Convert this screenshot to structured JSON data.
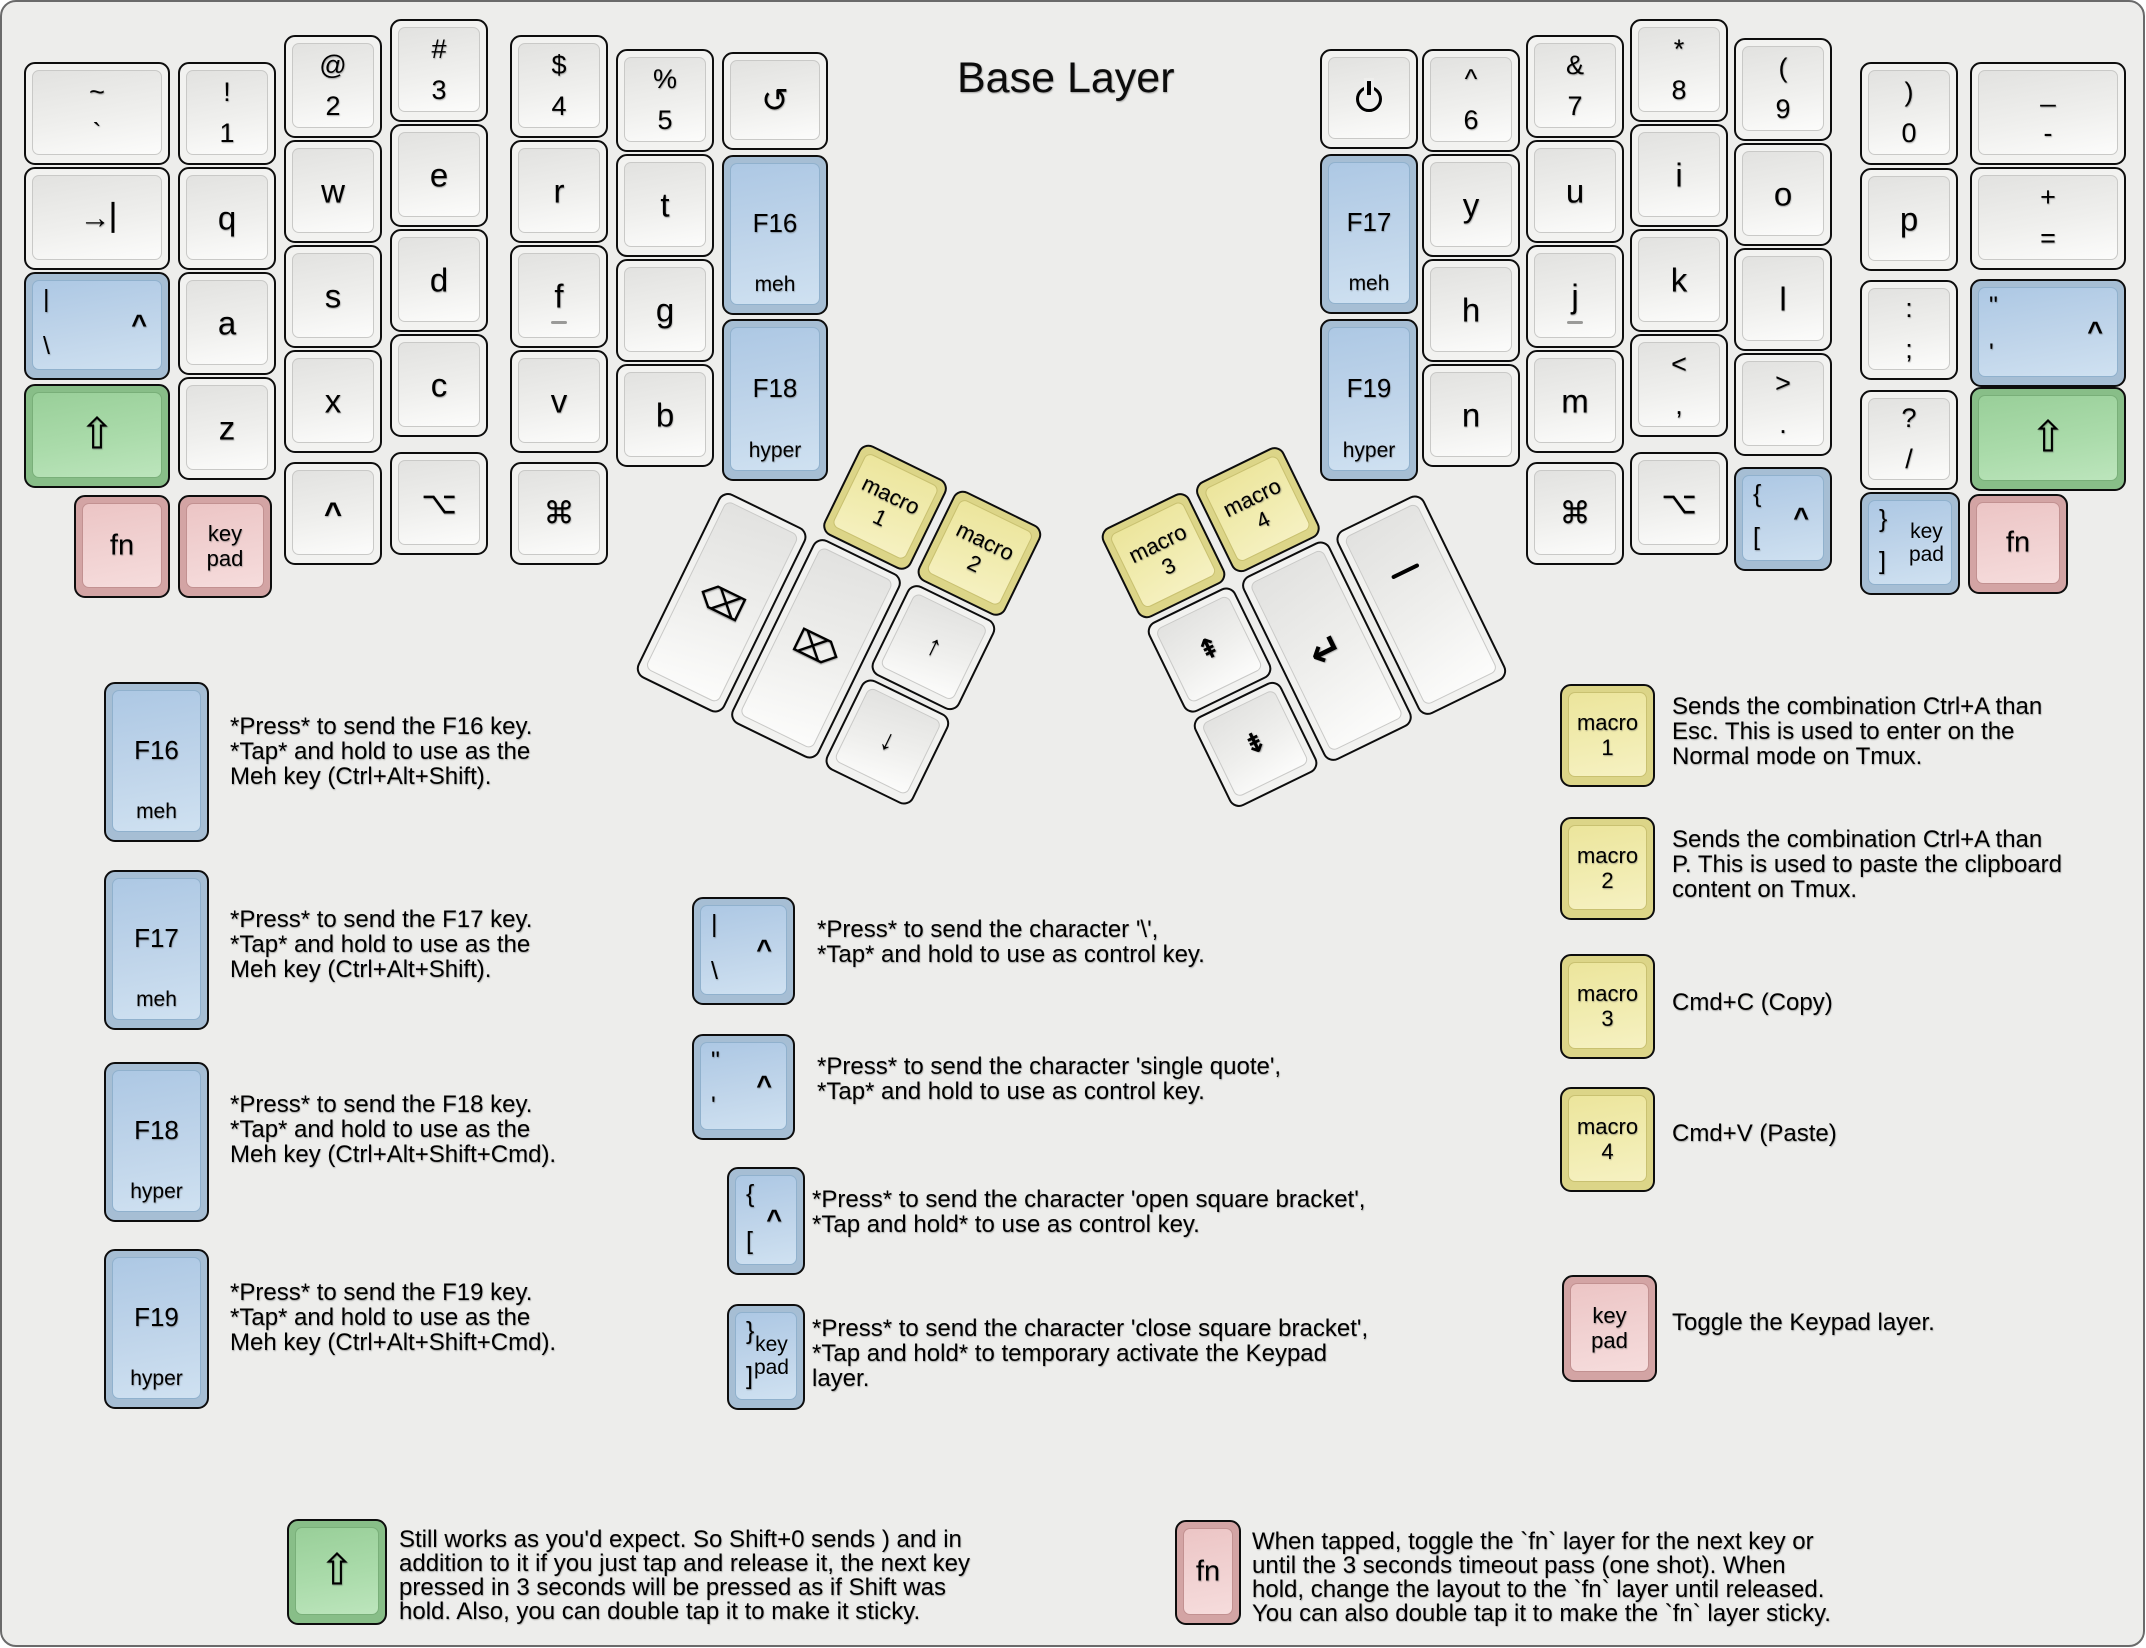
{
  "title": "Base Layer",
  "colors": {
    "background": "#ededeb",
    "modifier_blue": "#a6bed4",
    "shift_green": "#88be88",
    "layer_pink": "#d3a4a4",
    "macro_yellow": "#dcd588",
    "key_white": "#f2f2f0"
  },
  "board": {
    "keys": [
      {
        "n": "key-grave",
        "x": 22,
        "y": 60,
        "w": 146,
        "t": "~",
        "b": "`"
      },
      {
        "n": "key-1",
        "x": 176,
        "y": 60,
        "t": "!",
        "b": "1"
      },
      {
        "n": "key-2",
        "x": 282,
        "y": 33,
        "t": "@",
        "b": "2"
      },
      {
        "n": "key-3",
        "x": 388,
        "y": 17,
        "t": "#",
        "b": "3"
      },
      {
        "n": "key-4",
        "x": 508,
        "y": 33,
        "t": "$",
        "b": "4"
      },
      {
        "n": "key-5",
        "x": 614,
        "y": 47,
        "t": "%",
        "b": "5"
      },
      {
        "n": "key-undo",
        "x": 720,
        "y": 50,
        "w": 106,
        "h": 98,
        "c": "↺",
        "k": "undo"
      },
      {
        "n": "key-tab",
        "x": 22,
        "y": 165,
        "w": 146,
        "icon": "tab"
      },
      {
        "n": "key-q",
        "x": 176,
        "y": 165,
        "c": "q",
        "k": "letter"
      },
      {
        "n": "key-w",
        "x": 282,
        "y": 138,
        "c": "w",
        "k": "letter"
      },
      {
        "n": "key-e",
        "x": 388,
        "y": 122,
        "c": "e",
        "k": "letter"
      },
      {
        "n": "key-r",
        "x": 508,
        "y": 138,
        "c": "r",
        "k": "letter"
      },
      {
        "n": "key-t",
        "x": 614,
        "y": 152,
        "c": "t",
        "k": "letter"
      },
      {
        "n": "key-f16",
        "x": 720,
        "y": 153,
        "w": 106,
        "h": 160,
        "col": "blue",
        "c": "F16",
        "sub": "meh",
        "k": "fkey"
      },
      {
        "n": "key-backslash-control",
        "x": 22,
        "y": 270,
        "w": 146,
        "h": 108,
        "col": "blue",
        "tl": "|",
        "bl": "\\",
        "r": "^"
      },
      {
        "n": "key-a",
        "x": 176,
        "y": 270,
        "c": "a",
        "k": "letter"
      },
      {
        "n": "key-s",
        "x": 282,
        "y": 243,
        "c": "s",
        "k": "letter"
      },
      {
        "n": "key-d",
        "x": 388,
        "y": 227,
        "c": "d",
        "k": "letter"
      },
      {
        "n": "key-f",
        "x": 508,
        "y": 243,
        "c": "f",
        "k": "letter",
        "homing": true
      },
      {
        "n": "key-g",
        "x": 614,
        "y": 257,
        "c": "g",
        "k": "letter"
      },
      {
        "n": "key-f18",
        "x": 720,
        "y": 317,
        "w": 106,
        "h": 162,
        "col": "blue",
        "c": "F18",
        "sub": "hyper",
        "k": "fkey"
      },
      {
        "n": "key-left-shift",
        "x": 22,
        "y": 382,
        "w": 146,
        "h": 104,
        "col": "green",
        "c": "⇧",
        "k": "shift"
      },
      {
        "n": "key-z",
        "x": 176,
        "y": 375,
        "c": "z",
        "k": "letter"
      },
      {
        "n": "key-x",
        "x": 282,
        "y": 348,
        "c": "x",
        "k": "letter"
      },
      {
        "n": "key-c",
        "x": 388,
        "y": 332,
        "c": "c",
        "k": "letter"
      },
      {
        "n": "key-v",
        "x": 508,
        "y": 348,
        "c": "v",
        "k": "letter"
      },
      {
        "n": "key-b",
        "x": 614,
        "y": 362,
        "c": "b",
        "k": "letter"
      },
      {
        "n": "key-fn-left",
        "x": 72,
        "y": 493,
        "w": 96,
        "col": "pink",
        "c": "fn",
        "k": "fn"
      },
      {
        "n": "key-keypad-left",
        "x": 176,
        "y": 493,
        "w": 94,
        "col": "pink",
        "c2": [
          "key",
          "pad"
        ]
      },
      {
        "n": "key-control-left",
        "x": 282,
        "y": 460,
        "c": "^",
        "k": "caret"
      },
      {
        "n": "key-option-left",
        "x": 388,
        "y": 450,
        "c": "⌥",
        "k": "mod"
      },
      {
        "n": "key-command-left",
        "x": 508,
        "y": 460,
        "c": "⌘",
        "k": "mod"
      },
      {
        "n": "key-power",
        "x": 1318,
        "y": 47,
        "h": 100,
        "icon": "power"
      },
      {
        "n": "key-6",
        "x": 1420,
        "y": 47,
        "t": "^",
        "b": "6"
      },
      {
        "n": "key-7",
        "x": 1524,
        "y": 33,
        "t": "&",
        "b": "7"
      },
      {
        "n": "key-8",
        "x": 1628,
        "y": 17,
        "t": "*",
        "b": "8"
      },
      {
        "n": "key-9",
        "x": 1732,
        "y": 36,
        "t": "(",
        "b": "9"
      },
      {
        "n": "key-0",
        "x": 1858,
        "y": 60,
        "t": ")",
        "b": "0"
      },
      {
        "n": "key-minus",
        "x": 1968,
        "y": 60,
        "w": 156,
        "t": "_",
        "b": "-"
      },
      {
        "n": "key-f17",
        "x": 1318,
        "y": 152,
        "h": 160,
        "col": "blue",
        "c": "F17",
        "sub": "meh",
        "k": "fkey"
      },
      {
        "n": "key-y",
        "x": 1420,
        "y": 152,
        "c": "y",
        "k": "letter"
      },
      {
        "n": "key-u",
        "x": 1524,
        "y": 138,
        "c": "u",
        "k": "letter"
      },
      {
        "n": "key-i",
        "x": 1628,
        "y": 122,
        "c": "i",
        "k": "letter"
      },
      {
        "n": "key-o",
        "x": 1732,
        "y": 141,
        "c": "o",
        "k": "letter"
      },
      {
        "n": "key-p",
        "x": 1858,
        "y": 166,
        "c": "p",
        "k": "letter"
      },
      {
        "n": "key-equals",
        "x": 1968,
        "y": 165,
        "w": 156,
        "t": "+",
        "b": "="
      },
      {
        "n": "key-f19",
        "x": 1318,
        "y": 317,
        "h": 162,
        "col": "blue",
        "c": "F19",
        "sub": "hyper",
        "k": "fkey"
      },
      {
        "n": "key-h",
        "x": 1420,
        "y": 257,
        "c": "h",
        "k": "letter"
      },
      {
        "n": "key-j",
        "x": 1524,
        "y": 243,
        "c": "j",
        "k": "letter",
        "homing": true
      },
      {
        "n": "key-k",
        "x": 1628,
        "y": 227,
        "c": "k",
        "k": "letter"
      },
      {
        "n": "key-l",
        "x": 1732,
        "y": 246,
        "c": "l",
        "k": "letter"
      },
      {
        "n": "key-semicolon",
        "x": 1858,
        "y": 278,
        "h": 100,
        "t": ":",
        "b": ";"
      },
      {
        "n": "key-quote-control",
        "x": 1968,
        "y": 277,
        "w": 156,
        "h": 108,
        "col": "blue",
        "tl": "\"",
        "bl": "'",
        "r": "^"
      },
      {
        "n": "key-n",
        "x": 1420,
        "y": 362,
        "c": "n",
        "k": "letter"
      },
      {
        "n": "key-m",
        "x": 1524,
        "y": 348,
        "c": "m",
        "k": "letter"
      },
      {
        "n": "key-comma",
        "x": 1628,
        "y": 332,
        "t": "<",
        "b": ","
      },
      {
        "n": "key-period",
        "x": 1732,
        "y": 351,
        "t": ">",
        "b": "."
      },
      {
        "n": "key-slash",
        "x": 1858,
        "y": 388,
        "h": 100,
        "t": "?",
        "b": "/"
      },
      {
        "n": "key-right-shift",
        "x": 1968,
        "y": 385,
        "w": 156,
        "h": 104,
        "col": "green",
        "c": "⇧",
        "k": "shift"
      },
      {
        "n": "key-command-right",
        "x": 1524,
        "y": 460,
        "c": "⌘",
        "k": "mod"
      },
      {
        "n": "key-option-right",
        "x": 1628,
        "y": 450,
        "c": "⌥",
        "k": "mod"
      },
      {
        "n": "key-bracket-open-control",
        "x": 1732,
        "y": 465,
        "h": 104,
        "col": "blue",
        "tl": "{",
        "bl": "[",
        "r": "^"
      },
      {
        "n": "key-bracket-close-keypad",
        "x": 1858,
        "y": 490,
        "w": 100,
        "col": "blue",
        "tl": "}",
        "bl": "]",
        "rt": [
          "key",
          "pad"
        ]
      },
      {
        "n": "key-fn-right",
        "x": 1966,
        "y": 492,
        "w": 100,
        "h": 100,
        "col": "pink",
        "c": "fn",
        "k": "fn"
      }
    ],
    "left_thumb": {
      "name": "left-thumb-cluster",
      "x": 767,
      "y": 393,
      "rotation": 26,
      "keys": [
        {
          "n": "key-macro-1",
          "x": 105,
          "y": 0,
          "w": 97,
          "h": 100,
          "col": "yellow",
          "c2": [
            "macro",
            "1"
          ]
        },
        {
          "n": "key-macro-2",
          "x": 210,
          "y": 0,
          "w": 97,
          "h": 100,
          "col": "yellow",
          "c2": [
            "macro",
            "2"
          ]
        },
        {
          "n": "key-backspace",
          "x": 0,
          "y": 105,
          "w": 97,
          "h": 205,
          "c": "⌫",
          "k": "del"
        },
        {
          "n": "key-delete",
          "x": 105,
          "y": 105,
          "w": 97,
          "h": 205,
          "c": "⌦",
          "k": "del"
        },
        {
          "n": "key-arrow-up",
          "x": 210,
          "y": 105,
          "w": 97,
          "h": 100,
          "c": "↑",
          "k": "arrow"
        },
        {
          "n": "key-arrow-down",
          "x": 210,
          "y": 210,
          "w": 97,
          "h": 100,
          "c": "↓",
          "k": "arrow"
        }
      ]
    },
    "right_thumb": {
      "name": "right-thumb-cluster",
      "x": 1096,
      "y": 530,
      "rotation": -26,
      "keys": [
        {
          "n": "key-macro-3",
          "x": 0,
          "y": 0,
          "w": 97,
          "h": 100,
          "col": "yellow",
          "c2": [
            "macro",
            "3"
          ]
        },
        {
          "n": "key-macro-4",
          "x": 105,
          "y": 0,
          "w": 97,
          "h": 100,
          "col": "yellow",
          "c2": [
            "macro",
            "4"
          ]
        },
        {
          "n": "key-page-up",
          "x": 0,
          "y": 105,
          "w": 97,
          "h": 100,
          "c": "⇞",
          "k": "pg"
        },
        {
          "n": "key-page-down",
          "x": 0,
          "y": 210,
          "w": 97,
          "h": 100,
          "c": "⇟",
          "k": "pg"
        },
        {
          "n": "key-enter",
          "x": 105,
          "y": 105,
          "w": 97,
          "h": 205,
          "c": "↵",
          "k": "enter"
        },
        {
          "n": "key-space",
          "x": 210,
          "y": 105,
          "w": 97,
          "h": 205,
          "icon": "space"
        }
      ]
    }
  },
  "legend_items": [
    {
      "key": {
        "n": "legend-key-f16",
        "x": 102,
        "y": 680,
        "w": 105,
        "h": 160,
        "col": "blue",
        "c": "F16",
        "sub": "meh",
        "k": "fkey"
      },
      "text": {
        "x": 228,
        "y": 712,
        "lines": [
          "*Press* to send the F16 key.",
          "*Tap* and hold to use as the",
          "Meh key (Ctrl+Alt+Shift)."
        ]
      }
    },
    {
      "key": {
        "n": "legend-key-f17",
        "x": 102,
        "y": 868,
        "w": 105,
        "h": 160,
        "col": "blue",
        "c": "F17",
        "sub": "meh",
        "k": "fkey"
      },
      "text": {
        "x": 228,
        "y": 905,
        "lines": [
          "*Press* to send the F17 key.",
          "*Tap* and hold to use as the",
          "Meh key (Ctrl+Alt+Shift)."
        ]
      }
    },
    {
      "key": {
        "n": "legend-key-f18",
        "x": 102,
        "y": 1060,
        "w": 105,
        "h": 160,
        "col": "blue",
        "c": "F18",
        "sub": "hyper",
        "k": "fkey"
      },
      "text": {
        "x": 228,
        "y": 1090,
        "lines": [
          "*Press* to send the F18 key.",
          "*Tap* and hold to use as the",
          "Meh key (Ctrl+Alt+Shift+Cmd)."
        ]
      }
    },
    {
      "key": {
        "n": "legend-key-f19",
        "x": 102,
        "y": 1247,
        "w": 105,
        "h": 160,
        "col": "blue",
        "c": "F19",
        "sub": "hyper",
        "k": "fkey"
      },
      "text": {
        "x": 228,
        "y": 1278,
        "lines": [
          "*Press* to send the F19 key.",
          "*Tap* and hold to use as the",
          "Meh key (Ctrl+Alt+Shift+Cmd)."
        ]
      }
    },
    {
      "key": {
        "n": "legend-key-backslash-control",
        "x": 690,
        "y": 895,
        "w": 103,
        "h": 108,
        "col": "blue",
        "tl": "|",
        "bl": "\\",
        "r": "^"
      },
      "text": {
        "x": 815,
        "y": 915,
        "lines": [
          "*Press* to send the character '\\',",
          "*Tap* and hold to use as control key."
        ]
      }
    },
    {
      "key": {
        "n": "legend-key-quote-control",
        "x": 690,
        "y": 1032,
        "w": 103,
        "h": 106,
        "col": "blue",
        "tl": "\"",
        "bl": "'",
        "r": "^"
      },
      "text": {
        "x": 815,
        "y": 1052,
        "lines": [
          "*Press* to send the character 'single quote',",
          "*Tap* and hold to use as control key."
        ]
      }
    },
    {
      "key": {
        "n": "legend-key-bracket-open-control",
        "x": 725,
        "y": 1165,
        "w": 78,
        "h": 108,
        "col": "blue",
        "tl": "{",
        "bl": "[",
        "r": "^"
      },
      "text": {
        "x": 810,
        "y": 1185,
        "lines": [
          "*Press* to send the character 'open square bracket',",
          "*Tap and hold* to use as control key."
        ]
      }
    },
    {
      "key": {
        "n": "legend-key-bracket-close-keypad",
        "x": 725,
        "y": 1302,
        "w": 78,
        "h": 106,
        "col": "blue",
        "tl": "}",
        "bl": "]",
        "rt": [
          "key",
          "pad"
        ]
      },
      "text": {
        "x": 810,
        "y": 1314,
        "lines": [
          "*Press* to send the character 'close square bracket',",
          "*Tap and hold* to temporary activate the Keypad",
          "layer."
        ]
      }
    },
    {
      "key": {
        "n": "legend-key-macro-1",
        "x": 1558,
        "y": 682,
        "w": 95,
        "h": 103,
        "col": "yellow",
        "c2": [
          "macro",
          "1"
        ]
      },
      "text": {
        "x": 1670,
        "y": 692,
        "lines": [
          "Sends the combination Ctrl+A than",
          "Esc. This is used to enter on the",
          "Normal mode on Tmux."
        ]
      }
    },
    {
      "key": {
        "n": "legend-key-macro-2",
        "x": 1558,
        "y": 815,
        "w": 95,
        "h": 103,
        "col": "yellow",
        "c2": [
          "macro",
          "2"
        ]
      },
      "text": {
        "x": 1670,
        "y": 825,
        "lines": [
          "Sends the combination Ctrl+A than",
          "P. This is used to paste the clipboard",
          "content on Tmux."
        ]
      }
    },
    {
      "key": {
        "n": "legend-key-macro-3",
        "x": 1558,
        "y": 952,
        "w": 95,
        "h": 105,
        "col": "yellow",
        "c2": [
          "macro",
          "3"
        ]
      },
      "text": {
        "x": 1670,
        "y": 988,
        "lines": [
          "Cmd+C (Copy)"
        ]
      }
    },
    {
      "key": {
        "n": "legend-key-macro-4",
        "x": 1558,
        "y": 1085,
        "w": 95,
        "h": 105,
        "col": "yellow",
        "c2": [
          "macro",
          "4"
        ]
      },
      "text": {
        "x": 1670,
        "y": 1119,
        "lines": [
          "Cmd+V (Paste)"
        ]
      }
    },
    {
      "key": {
        "n": "legend-key-keypad",
        "x": 1560,
        "y": 1273,
        "w": 95,
        "h": 107,
        "col": "pink",
        "c2": [
          "key",
          "pad"
        ]
      },
      "text": {
        "x": 1670,
        "y": 1308,
        "lines": [
          "Toggle the Keypad layer."
        ]
      }
    },
    {
      "key": {
        "n": "legend-key-shift",
        "x": 285,
        "y": 1517,
        "w": 100,
        "h": 106,
        "col": "green",
        "c": "⇧",
        "k": "shift"
      },
      "text": {
        "x": 397,
        "y": 1526,
        "lh": 24,
        "lines": [
          "Still works as you'd expect. So Shift+0 sends ) and in",
          "addition to it if you just tap and release it, the next key",
          "pressed in 3 seconds will be pressed as if Shift was",
          "hold. Also, you can double tap it to make it sticky."
        ]
      }
    },
    {
      "key": {
        "n": "legend-key-fn",
        "x": 1173,
        "y": 1518,
        "w": 66,
        "h": 105,
        "col": "pink",
        "c": "fn",
        "k": "fn"
      },
      "text": {
        "x": 1250,
        "y": 1528,
        "lh": 24,
        "lines": [
          "When tapped, toggle the `fn` layer for the next key or",
          "until the 3 seconds timeout pass (one shot). When",
          "hold, change the layout to the `fn` layer until released.",
          "You can also double tap it to make the `fn` layer sticky."
        ]
      }
    }
  ]
}
